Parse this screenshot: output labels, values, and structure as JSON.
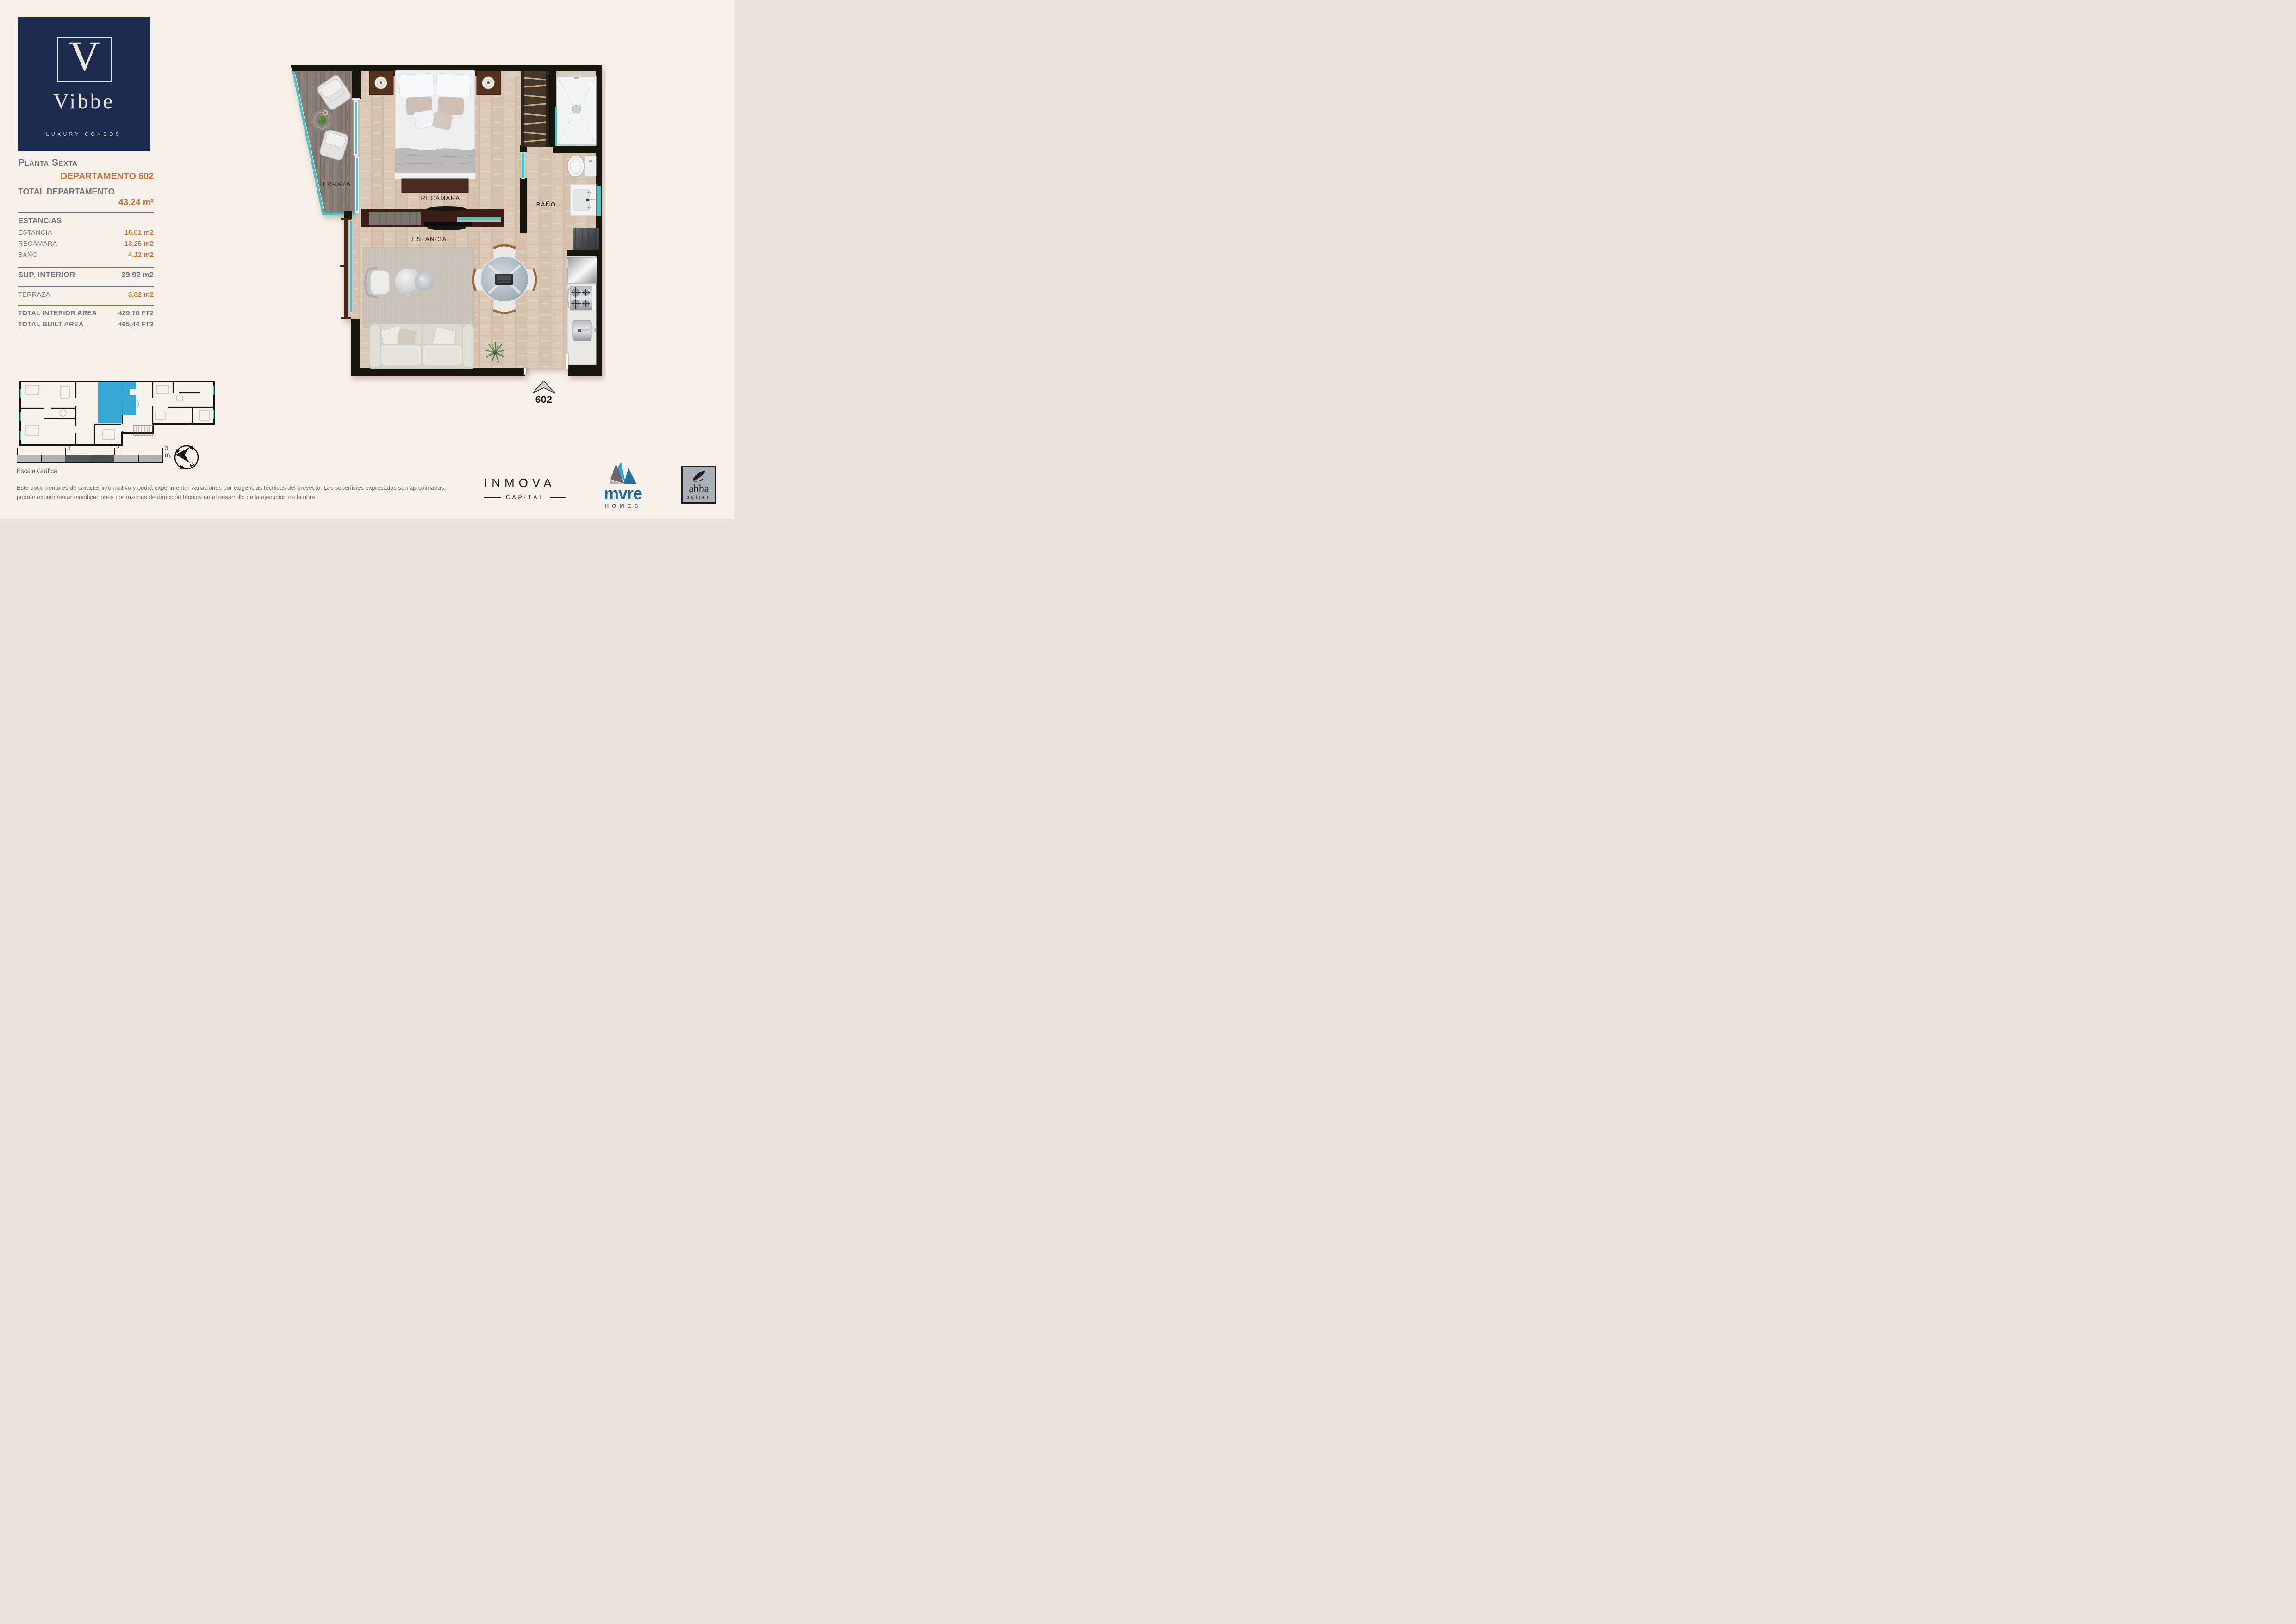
{
  "logo": {
    "initial": "V",
    "brand": "Vibbe",
    "tagline": "LUXURY CONDOS"
  },
  "sidebar": {
    "floor": "Planta Sexta",
    "unit": "DEPARTAMENTO 602",
    "total_label": "TOTAL DEPARTAMENTO",
    "total_value": "43,24 m²",
    "sections_title": "ESTANCIAS",
    "rooms": [
      {
        "label": "ESTANCIA",
        "value": "18,01 m2"
      },
      {
        "label": "RECÁMARA",
        "value": "13,25 m2"
      },
      {
        "label": "BAÑO",
        "value": "4,12 m2"
      }
    ],
    "sup_interior": {
      "label": "SUP. INTERIOR",
      "value": "39,92 m2"
    },
    "terraza": {
      "label": "TERRAZA",
      "value": "3,32 m2"
    },
    "totals": [
      {
        "label": "TOTAL INTERIOR AREA",
        "value": "429,70 FT2"
      },
      {
        "label": "TOTAL BUILT AREA",
        "value": "465,44 FT2"
      }
    ]
  },
  "plan": {
    "rooms": {
      "terraza": "TERRAZA",
      "recamara": "RECÁMARA",
      "estancia": "ESTANCIA",
      "bano": "BAÑO"
    },
    "unit_number": "602"
  },
  "scale_bar": {
    "ticks": [
      "1",
      "2",
      "3 m."
    ],
    "caption": "Escala Gráfica"
  },
  "compass": {
    "north": "N"
  },
  "disclaimer": {
    "line1": "Este documento es de caracter informativo y podrá experimentar variaciones por exigencias técnicas del proyecto. Las superficies expresadas son aproximadas,",
    "line2": "podrán experimentar modificaciones por razones de dirección técnica en el desarrollo de la ejecución de la obra."
  },
  "partners": {
    "inmova": {
      "name": "INMOVA",
      "division": "CAPITAL"
    },
    "mvre": {
      "name": "mvre",
      "division": "HOMES"
    },
    "abba": {
      "name": "abba",
      "division": "suites"
    }
  },
  "colors": {
    "navy": "#1D2B4E",
    "accent_orange": "#C56F3B",
    "label_gray": "#6E7479",
    "teal_glass": "#45C6C8",
    "wall_black": "#19130E",
    "keyplan_highlight": "#2DA3D2"
  }
}
